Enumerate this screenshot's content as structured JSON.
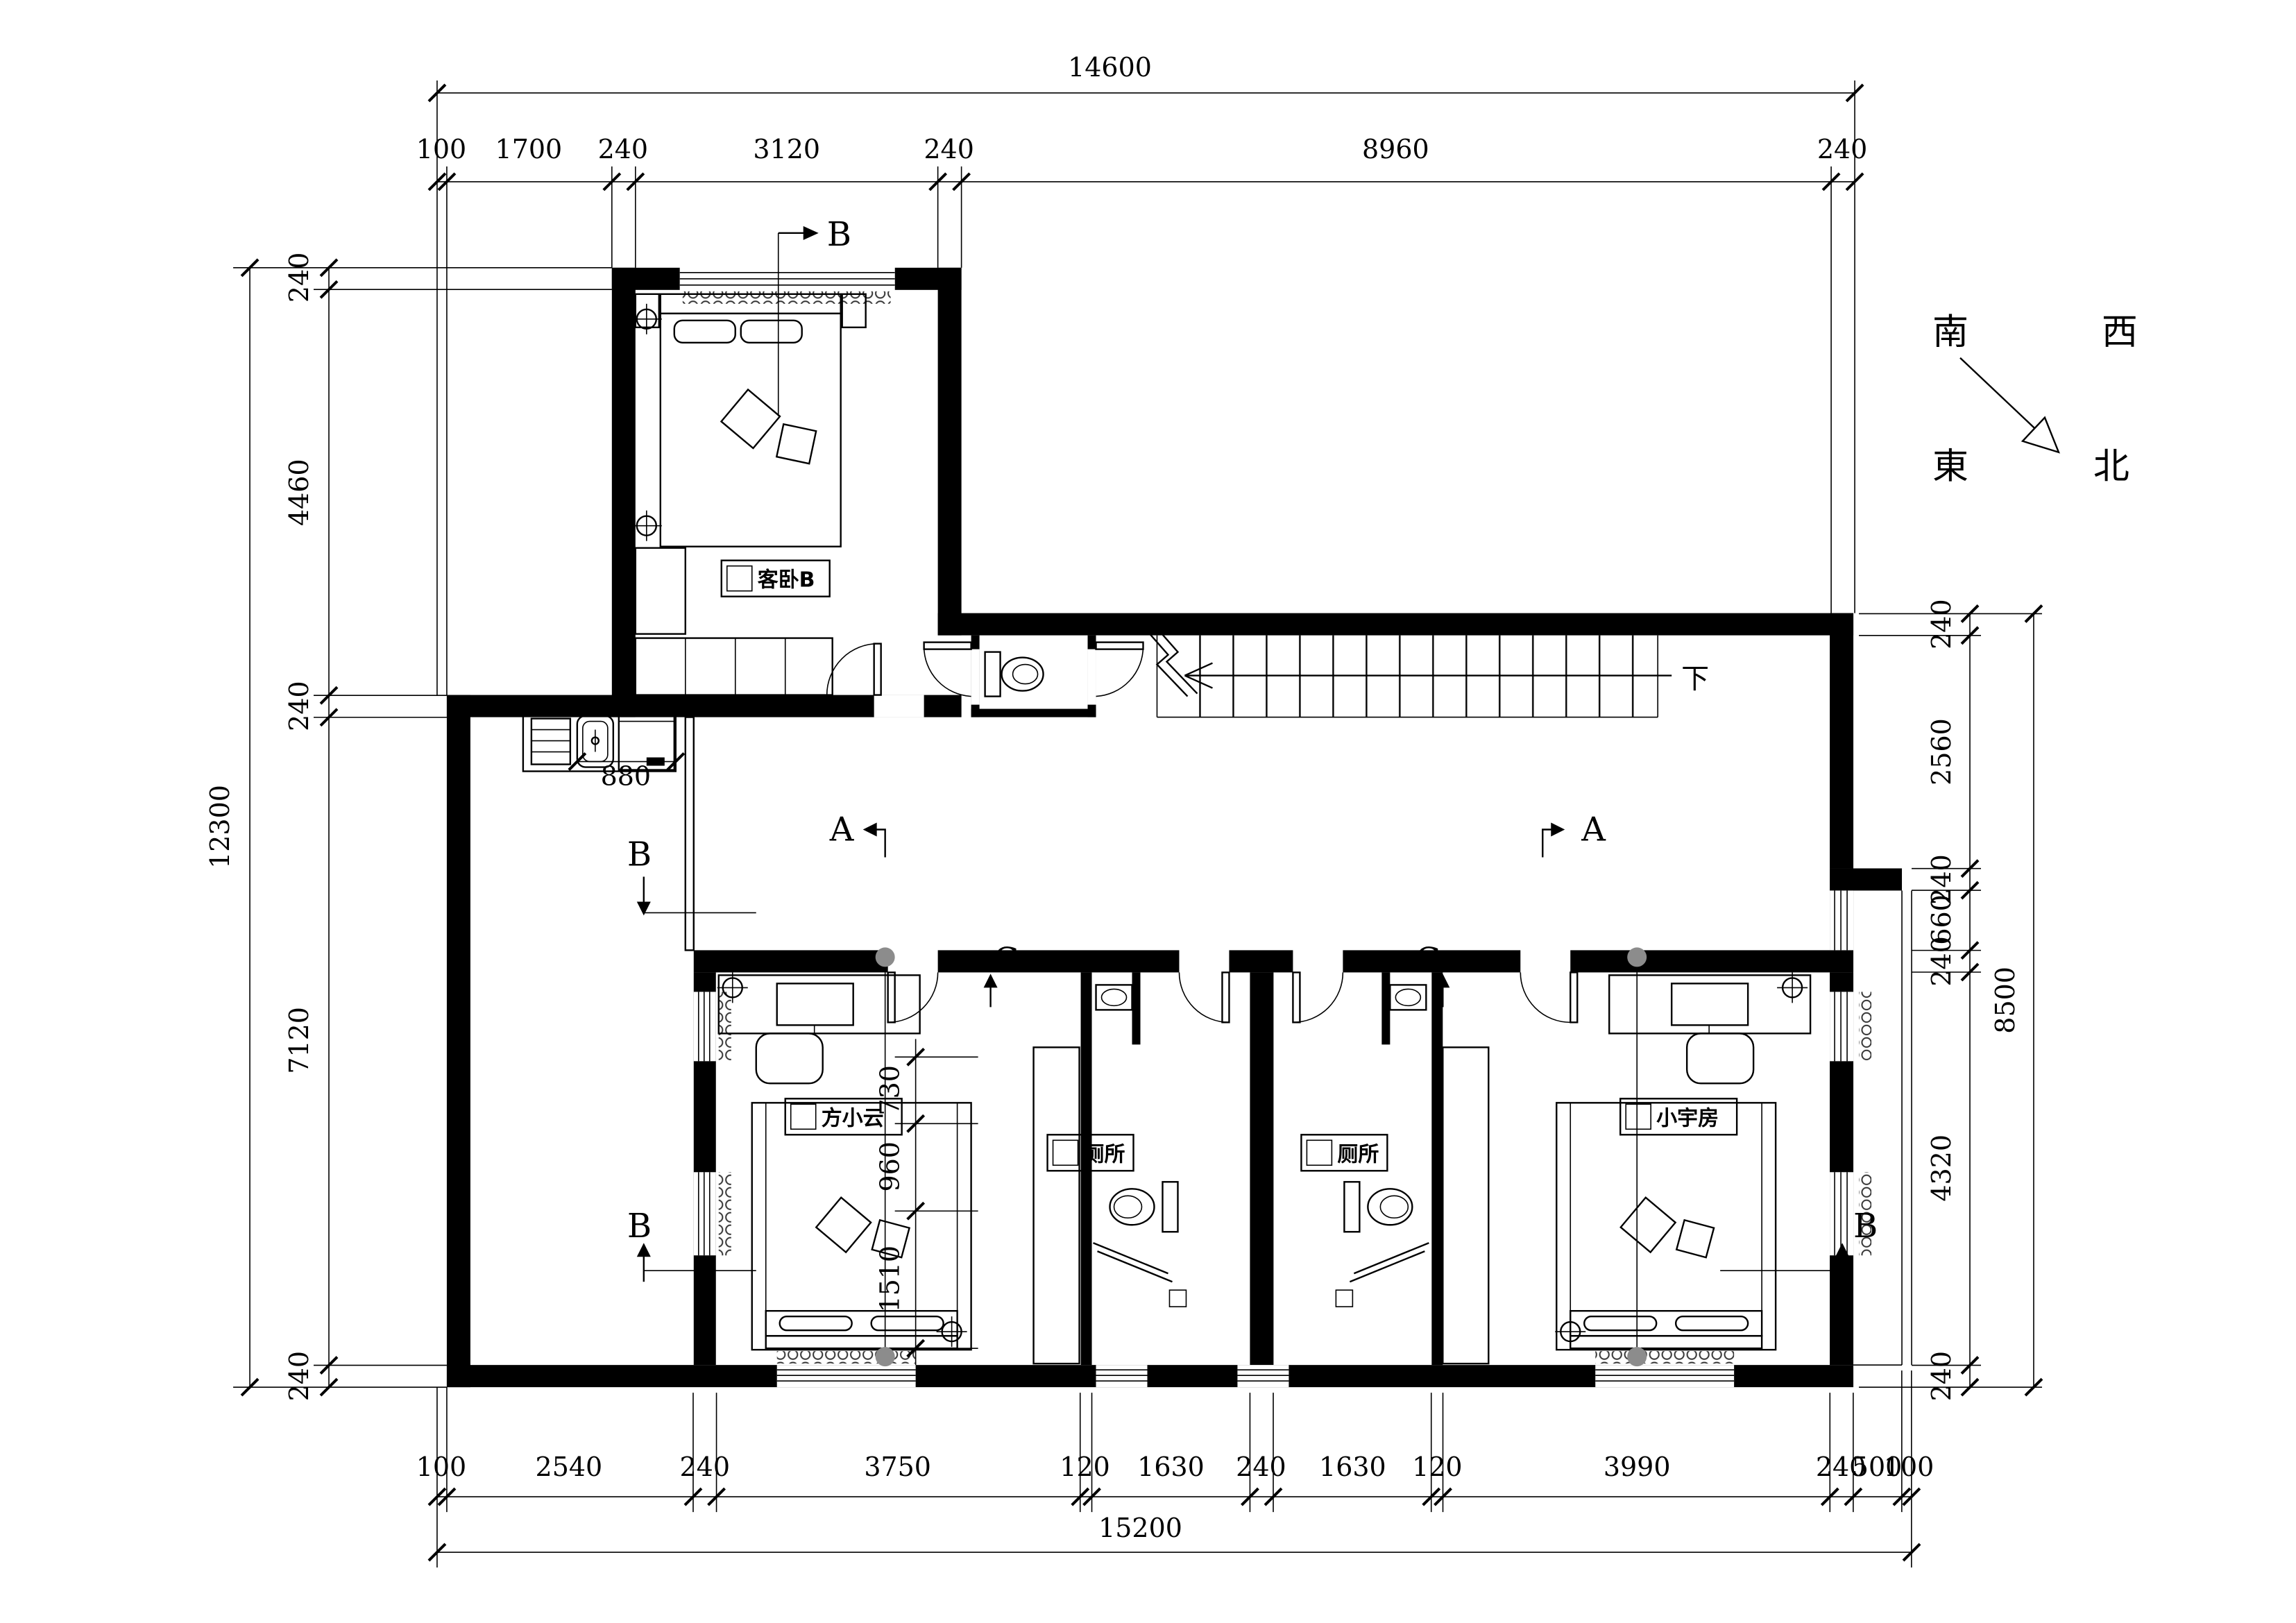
{
  "compass": {
    "south": "南",
    "west": "西",
    "east": "東",
    "north": "北"
  },
  "labels": {
    "bedroomB": "客卧B",
    "fangxiaoyun": "方小云",
    "toilet": "厕所",
    "xiaoyufang": "小宇房",
    "stairs_down": "下"
  },
  "sections": {
    "a": "A",
    "b": "B",
    "c": "C"
  },
  "dims": {
    "top": {
      "total": "14600",
      "segments": [
        "100",
        "1700",
        "240",
        "3120",
        "240",
        "8960",
        "240"
      ]
    },
    "bottom": {
      "total": "15200",
      "segments": [
        "100",
        "2540",
        "240",
        "3750",
        "120",
        "1630",
        "240",
        "1630",
        "120",
        "3990",
        "240",
        "500",
        "100"
      ]
    },
    "left": {
      "total": "12300",
      "segments": [
        "240",
        "4460",
        "240",
        "7120",
        "240"
      ]
    },
    "right": {
      "total": "8500",
      "segments": [
        "240",
        "2560",
        "240",
        "660",
        "240",
        "4320",
        "240"
      ]
    },
    "interior": {
      "kitchen": "880",
      "closet": [
        "730",
        "960",
        "1510"
      ]
    }
  }
}
